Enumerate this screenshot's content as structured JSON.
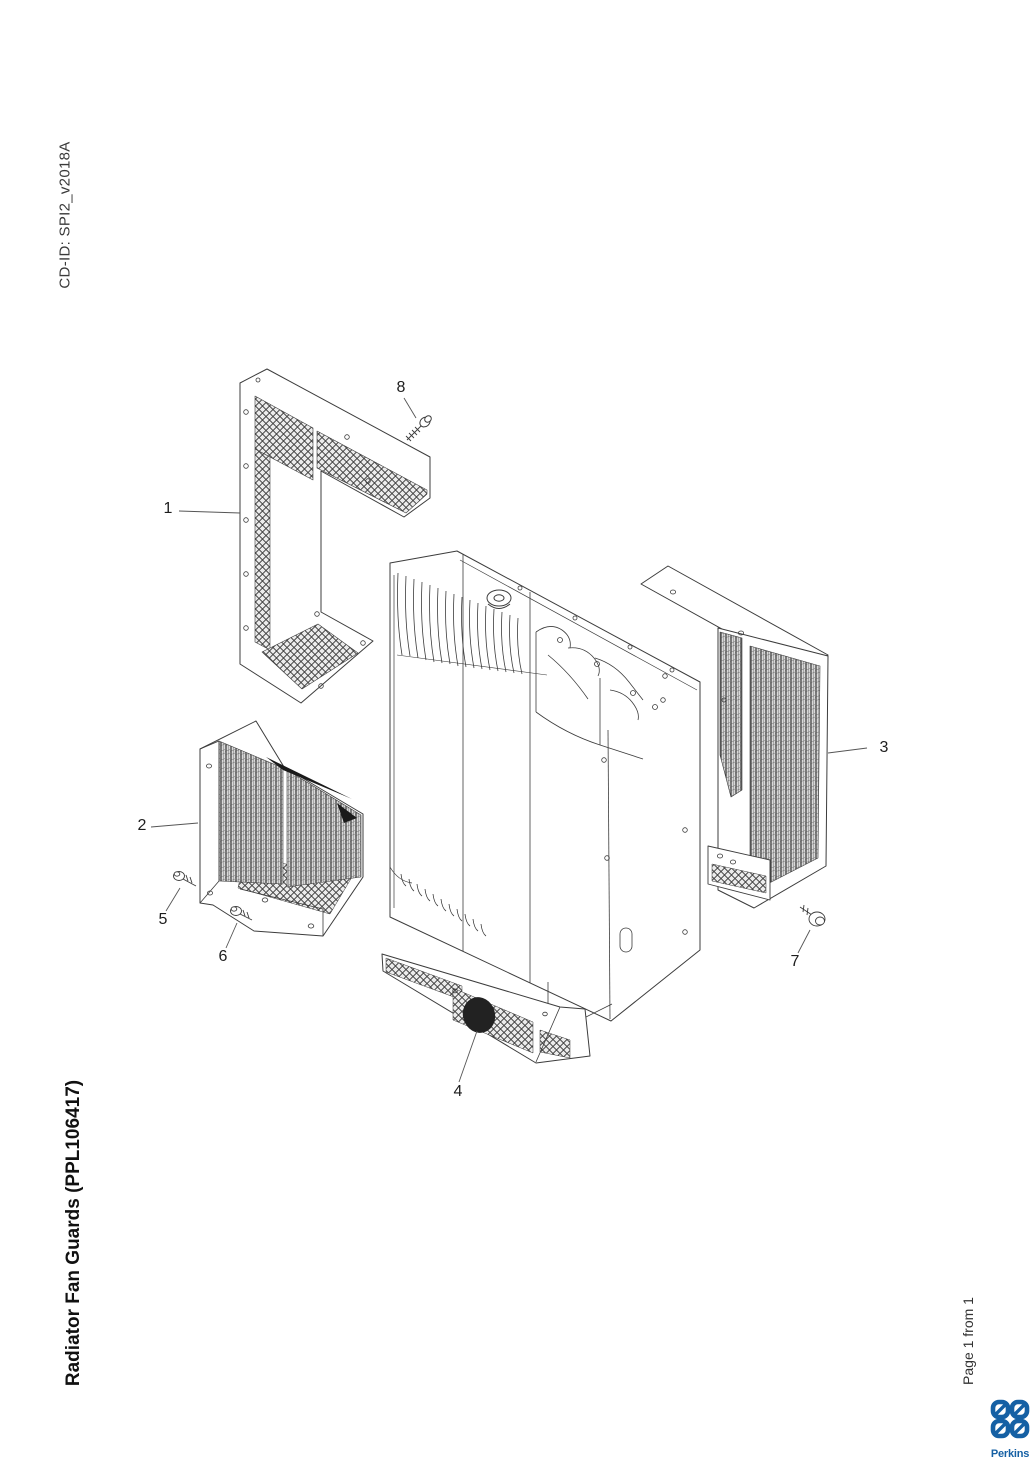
{
  "page": {
    "cd_id": "CD-ID: SPI2_v2018A",
    "title": "Radiator Fan Guards (PPL106417)",
    "page_indicator": "Page 1 from 1",
    "background": "#ffffff"
  },
  "brand": {
    "name": "Perkins",
    "color": "#1560a4"
  },
  "diagram": {
    "description": "Exploded isometric line drawing of radiator with fan guard panels and fixing bolts",
    "line_color": "#3c3c3c",
    "callouts": [
      {
        "label": "1",
        "x": 168,
        "y": 509
      },
      {
        "label": "2",
        "x": 142,
        "y": 826
      },
      {
        "label": "3",
        "x": 884,
        "y": 748
      },
      {
        "label": "4",
        "x": 458,
        "y": 1092
      },
      {
        "label": "5",
        "x": 163,
        "y": 920
      },
      {
        "label": "6",
        "x": 223,
        "y": 957
      },
      {
        "label": "7",
        "x": 795,
        "y": 962
      },
      {
        "label": "8",
        "x": 401,
        "y": 388
      }
    ]
  }
}
